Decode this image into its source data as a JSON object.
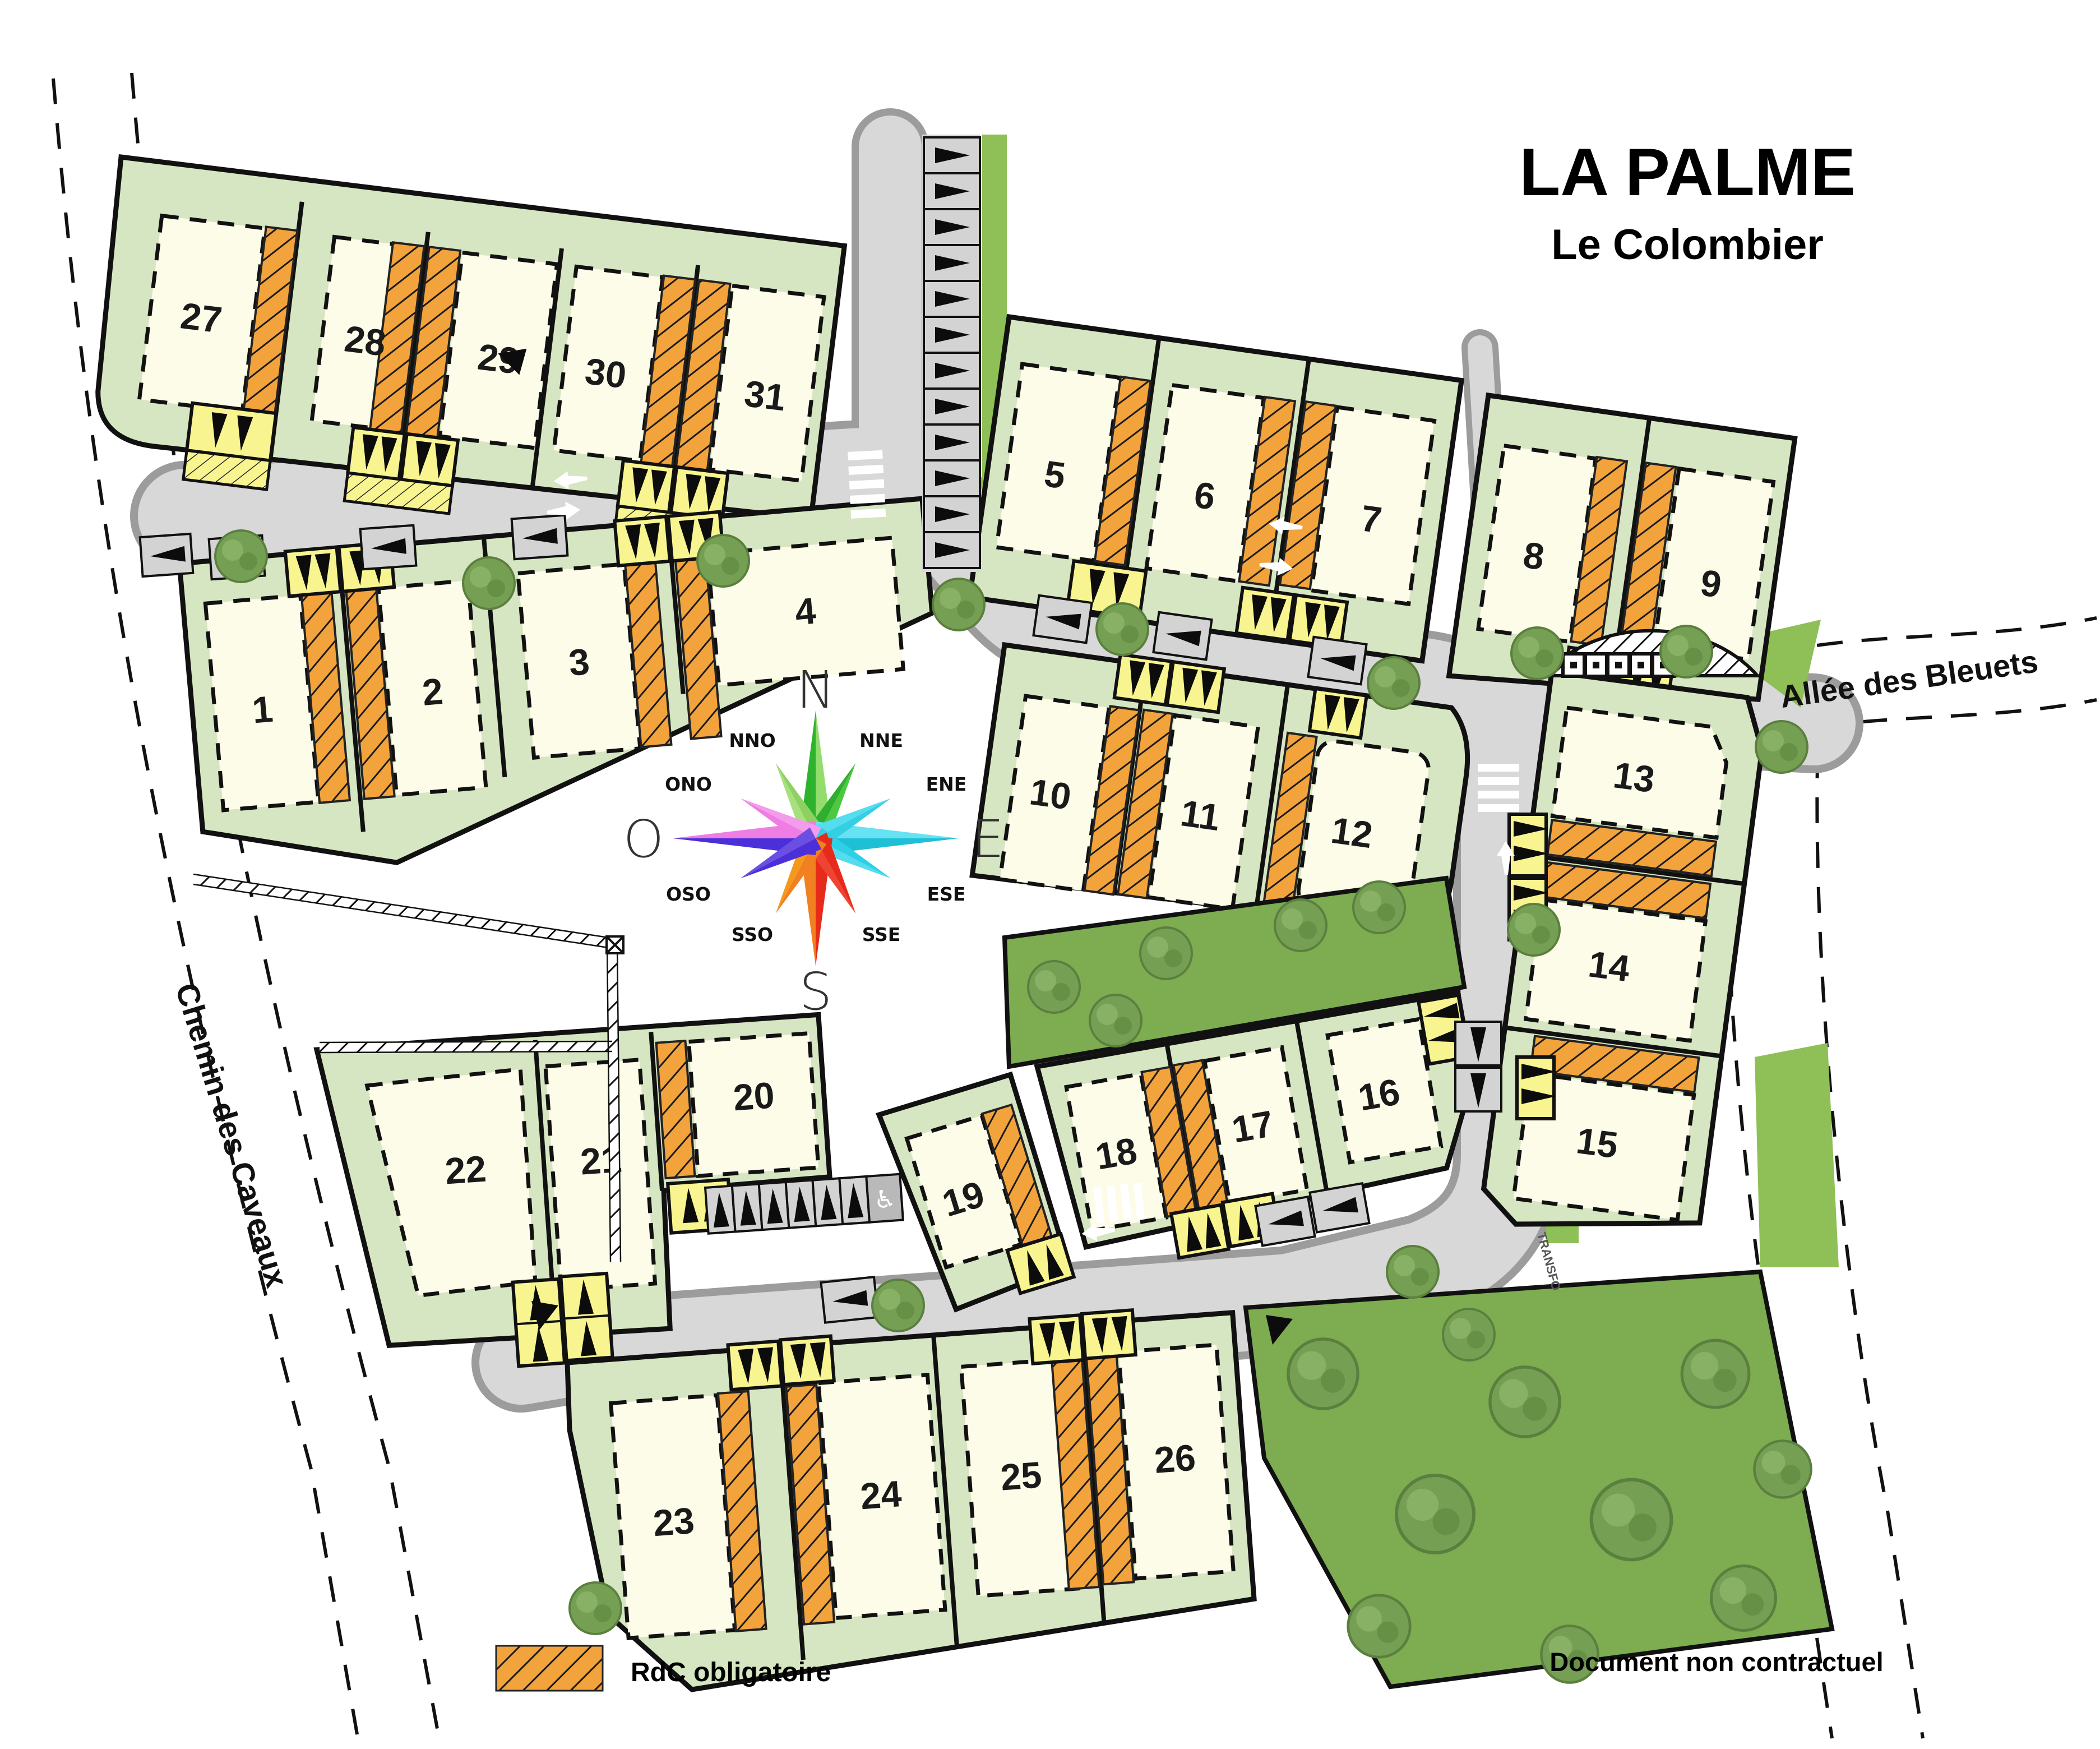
{
  "title": {
    "main": "LA PALME",
    "sub": "Le Colombier"
  },
  "legend": {
    "label": "RdC obligatoire",
    "swatch": "orange-diagonal-hatch"
  },
  "disclaimer": "Document non contractuel",
  "streets": {
    "left": "Chemin des Caveaux",
    "right": "Allée des Bleuets"
  },
  "compass": {
    "cardinals": {
      "n": "N",
      "s": "S",
      "e": "E",
      "o": "O"
    },
    "intercardinals": {
      "nno": "NNO",
      "nne": "NNE",
      "ene": "ENE",
      "ese": "ESE",
      "sse": "SSE",
      "sso": "SSO",
      "oso": "OSO",
      "ono": "ONO"
    }
  },
  "map": {
    "transfo": "TRANSFO",
    "accessible_icon": "♿"
  },
  "lots": {
    "1": "1",
    "2": "2",
    "3": "3",
    "4": "4",
    "5": "5",
    "6": "6",
    "7": "7",
    "8": "8",
    "9": "9",
    "10": "10",
    "11": "11",
    "12": "12",
    "13": "13",
    "14": "14",
    "15": "15",
    "16": "16",
    "17": "17",
    "18": "18",
    "19": "19",
    "20": "20",
    "21": "21",
    "22": "22",
    "23": "23",
    "24": "24",
    "25": "25",
    "26": "26",
    "27": "27",
    "28": "28",
    "29": "29",
    "30": "30",
    "31": "31"
  },
  "colors": {
    "parcel": "#d6e6c2",
    "building": "#fcfce9",
    "rdc_hatch": "#f2a33c",
    "parking": "#f8f590",
    "road": "#d8d8d8",
    "curb": "#9c9c9c",
    "park_green": "#7dac51",
    "accent_black": "#111111"
  }
}
